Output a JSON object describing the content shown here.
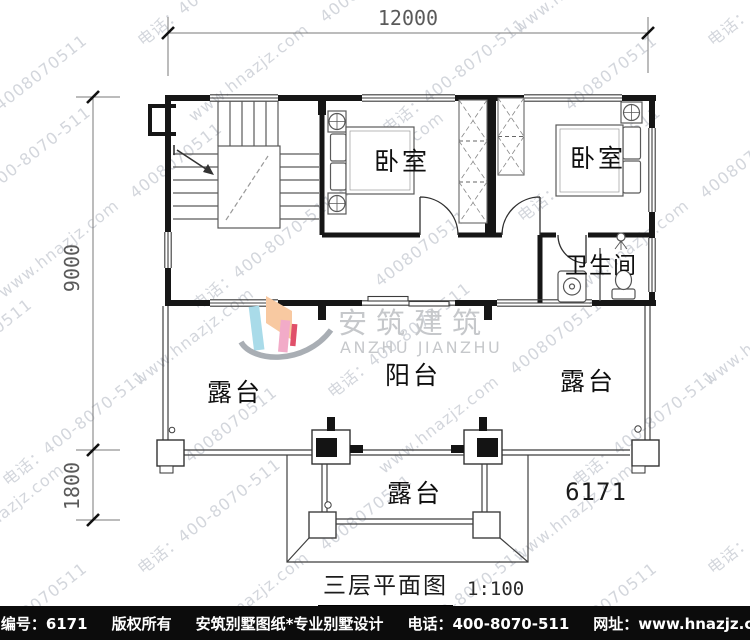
{
  "title_block": {
    "title": "三层平面图",
    "scale": "1:100"
  },
  "plan_number": "6171",
  "dimensions": {
    "width_total": "12000",
    "height_main": "9000",
    "height_terrace": "1800"
  },
  "labels": {
    "bedroom_center": "卧室",
    "bedroom_right": "卧室",
    "bathroom": "卫生间",
    "balcony": "阳台",
    "terrace_left": "露台",
    "terrace_right": "露台",
    "terrace_bottom": "露台"
  },
  "logo": {
    "name_cn": "安筑建筑",
    "name_en": "ANZHU JIANZHU",
    "colors": {
      "cyan": "#a9dbe9",
      "orange": "#f8c9a1",
      "pink": "#f2abc8",
      "red": "#e0506a",
      "swoosh": "#a9aeb4"
    }
  },
  "watermark": {
    "color": "#c9cdd4",
    "strings": [
      "www.hnazjz.com",
      "电话：400-8070-511",
      "4008070511"
    ]
  },
  "footer": {
    "items": [
      "本图编号：6171",
      "版权所有",
      "安筑别墅图纸*专业别墅设计",
      "电话：400-8070-511",
      "网址：www.hnazjz.com"
    ]
  }
}
